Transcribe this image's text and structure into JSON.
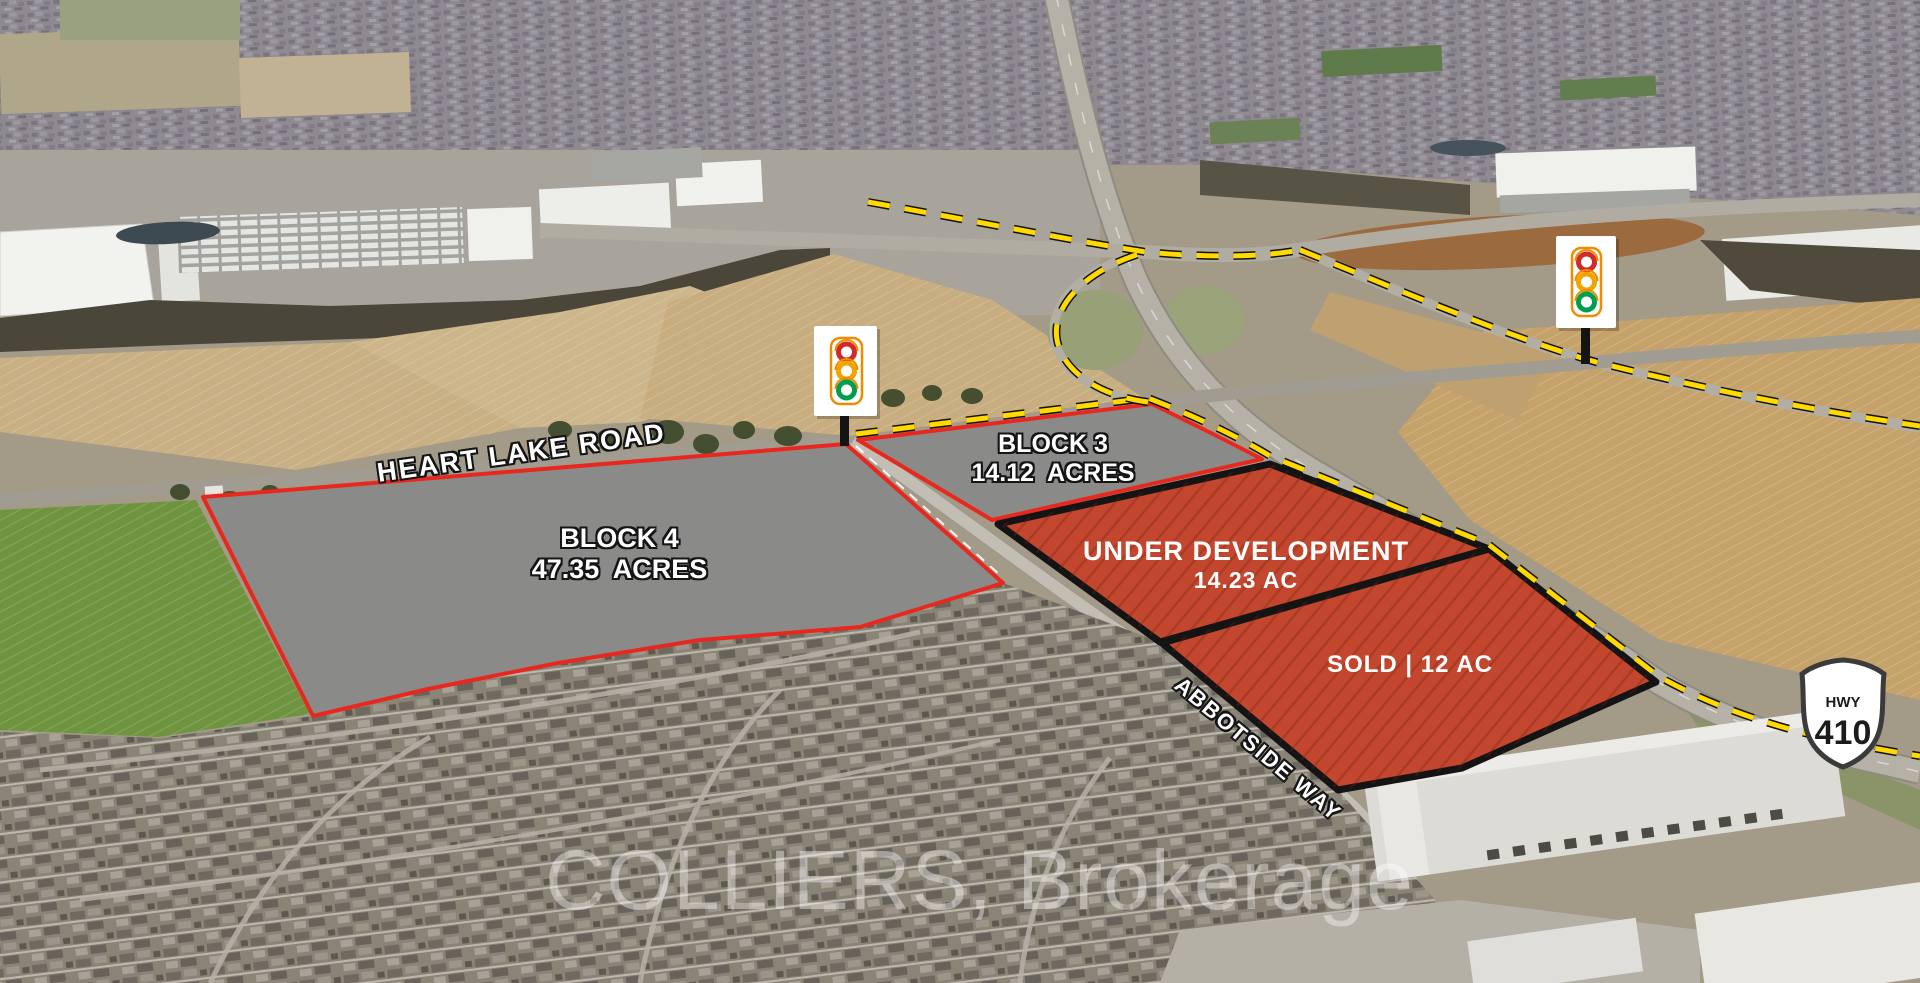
{
  "watermark": {
    "text": "COLLIERS, Brokerage"
  },
  "roads": {
    "heart_lake": {
      "label": "HEART LAKE ROAD"
    },
    "abbotside": {
      "label": "ABBOTSIDE WAY"
    },
    "highway_410": {
      "shield_label": "HWY",
      "shield_number": "410"
    }
  },
  "parcels": {
    "block4": {
      "name": "BLOCK 4",
      "area": "47.35  ACRES"
    },
    "block3": {
      "name": "BLOCK 3",
      "area": "14.12  ACRES"
    },
    "under_development": {
      "name": "UNDER DEVELOPMENT",
      "area": "14.23 AC"
    },
    "sold": {
      "name": "SOLD | 12 AC"
    }
  },
  "icons": {
    "traffic_light": "traffic-light-icon",
    "highway_shield": "hwy-410-shield-icon"
  },
  "colors": {
    "parcel_available_fill": "#8a8a88",
    "parcel_boundary_red": "#e8281e",
    "parcel_active_fill": "#c2472e",
    "parcel_boundary_black": "#141414",
    "route_dash_yellow": "#ffd900"
  }
}
